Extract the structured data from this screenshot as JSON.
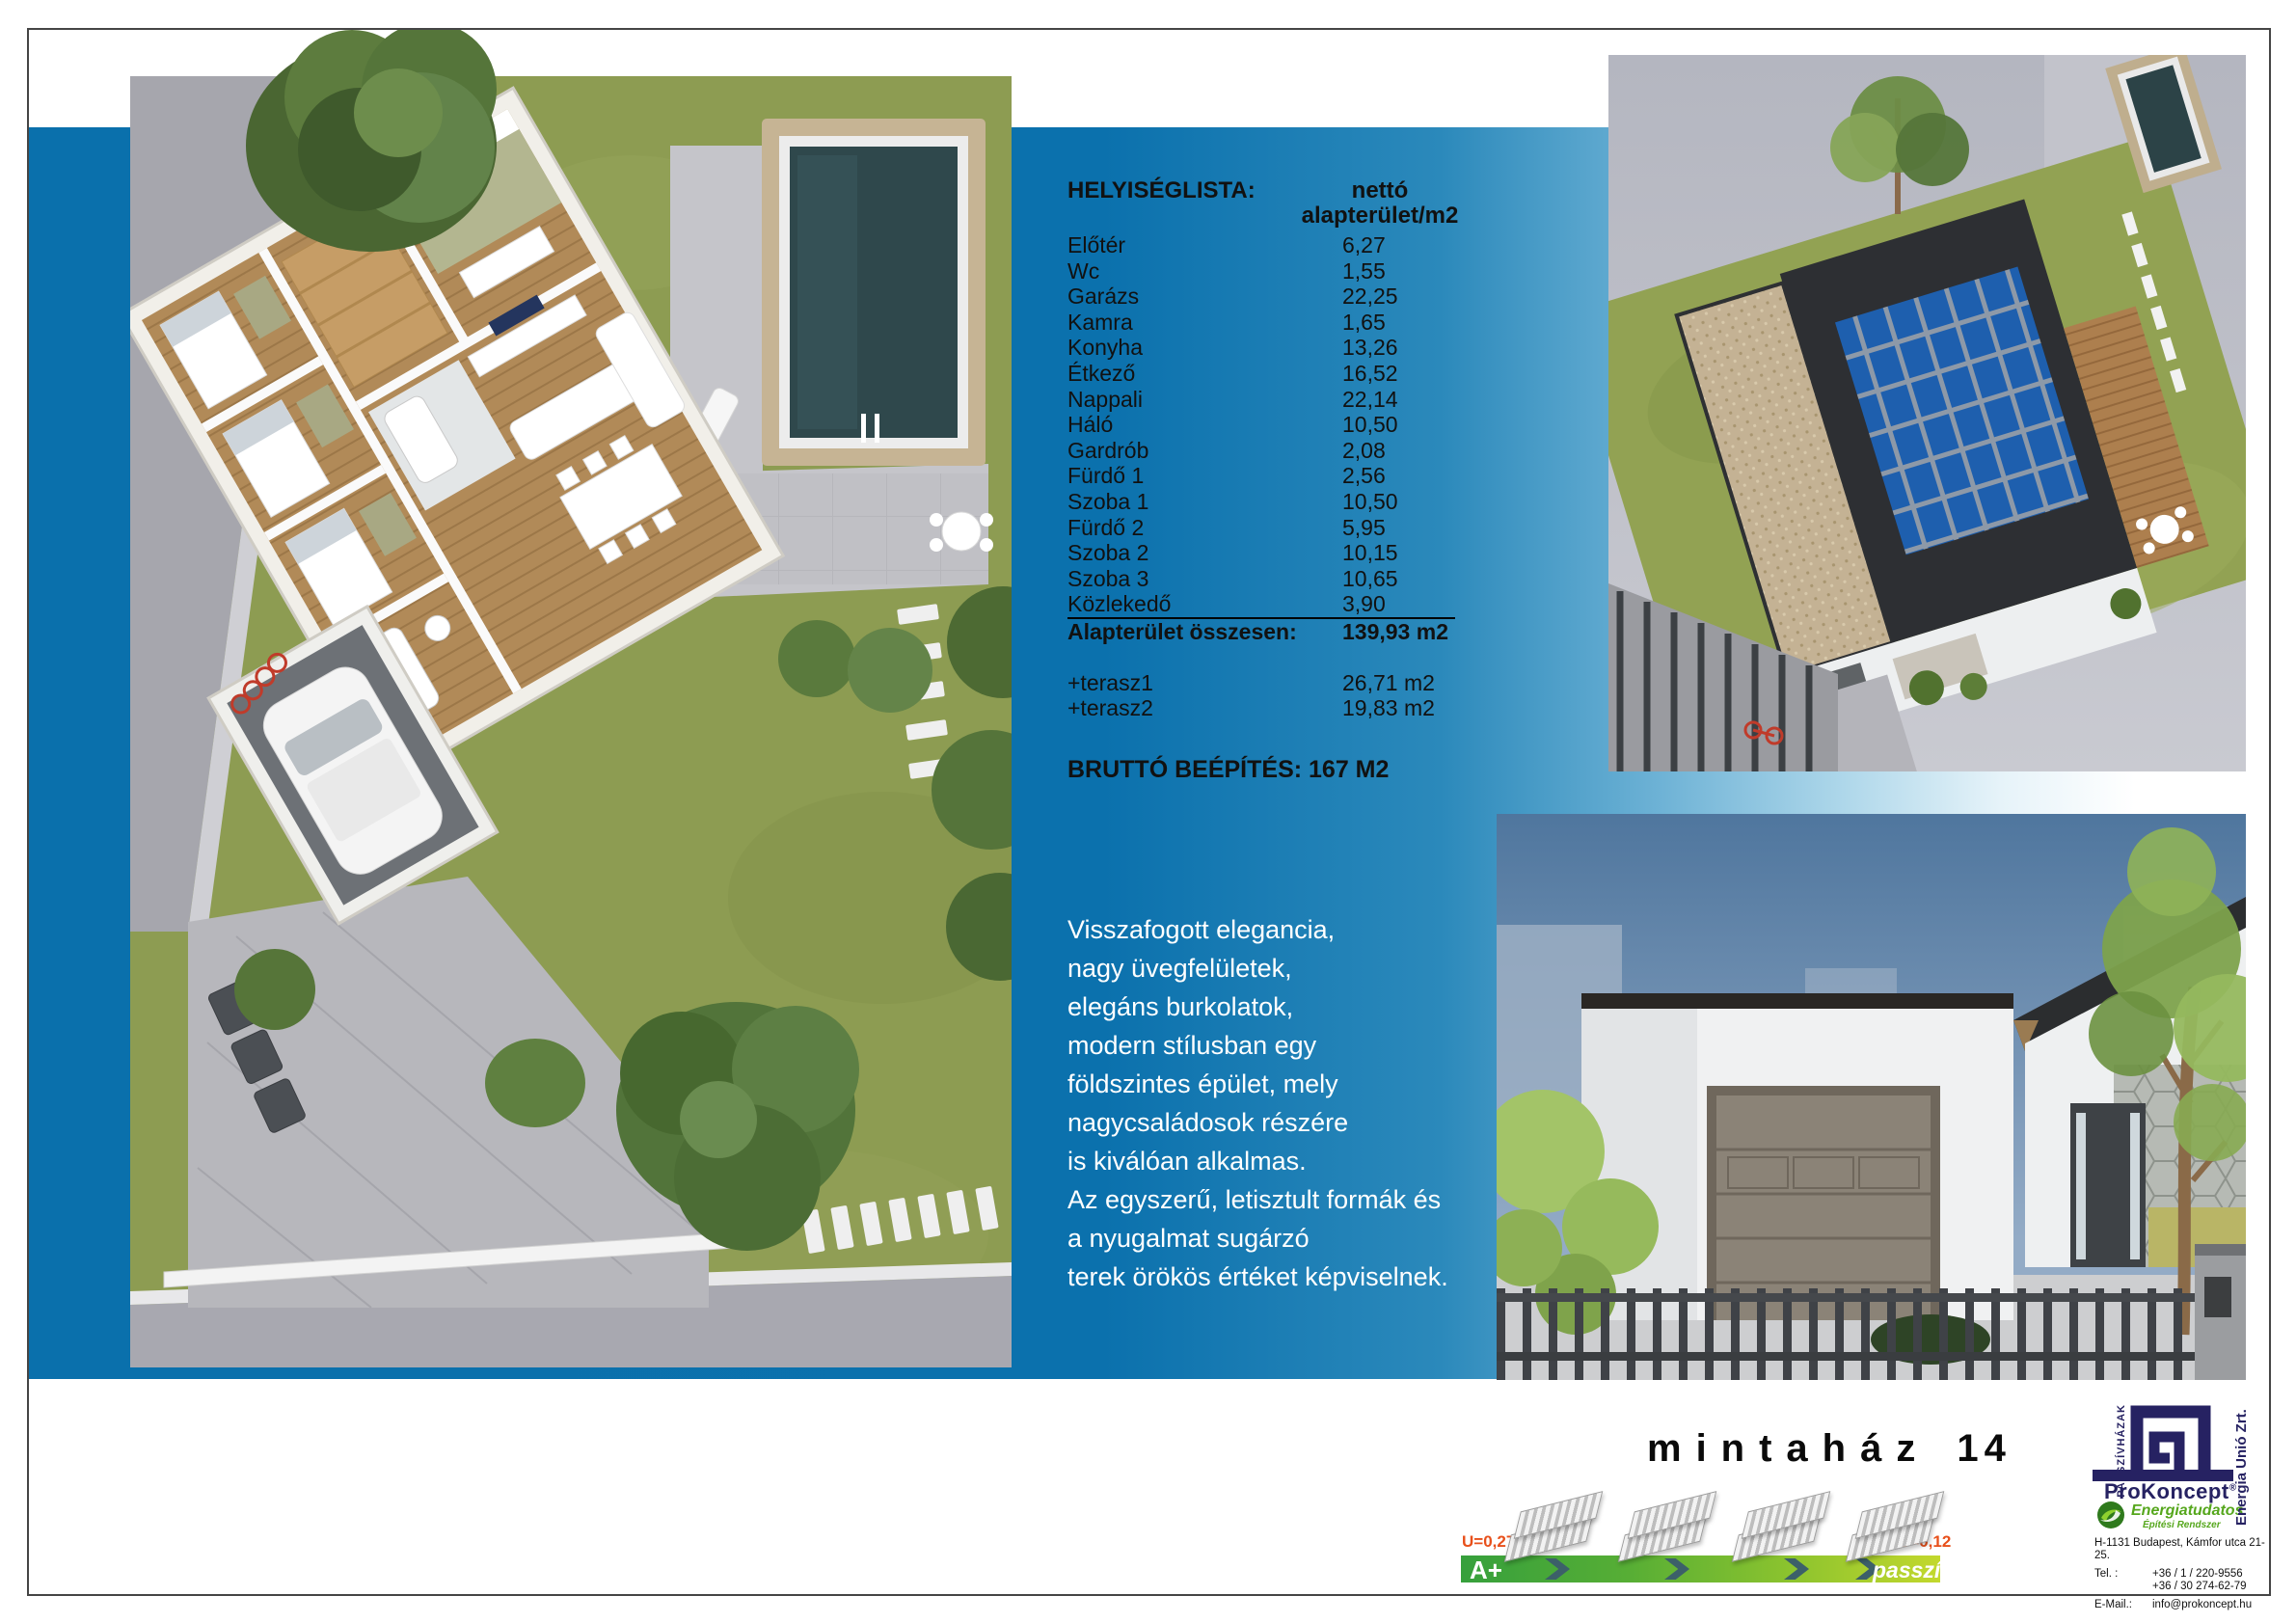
{
  "page": {
    "doc_type": "model house datasheet"
  },
  "title": {
    "word": "mintaház",
    "number": "14"
  },
  "room_list": {
    "heading": "HELYISÉGLISTA:",
    "col_header_line1": "nettó",
    "col_header_line2": "alapterület/m2",
    "rows": [
      {
        "name": "Előtér",
        "value": "6,27",
        "underline": false
      },
      {
        "name": "Wc",
        "value": "1,55",
        "underline": false
      },
      {
        "name": "Garázs",
        "value": "22,25",
        "underline": false
      },
      {
        "name": "Kamra",
        "value": "1,65",
        "underline": false
      },
      {
        "name": "Konyha",
        "value": "13,26",
        "underline": false
      },
      {
        "name": "Étkező",
        "value": "16,52",
        "underline": false
      },
      {
        "name": "Nappali",
        "value": "22,14",
        "underline": false
      },
      {
        "name": "Háló",
        "value": "10,50",
        "underline": false
      },
      {
        "name": "Gardrób",
        "value": "2,08",
        "underline": false
      },
      {
        "name": "Fürdő 1",
        "value": "2,56",
        "underline": false
      },
      {
        "name": "Szoba 1",
        "value": "10,50",
        "underline": false
      },
      {
        "name": "Fürdő 2",
        "value": "5,95",
        "underline": false
      },
      {
        "name": "Szoba 2",
        "value": "10,15",
        "underline": false
      },
      {
        "name": "Szoba 3",
        "value": "10,65",
        "underline": false
      },
      {
        "name": "Közlekedő",
        "value": "3,90",
        "underline": true
      }
    ],
    "total_label": "Alapterület összesen:",
    "total_value": "139,93 m2",
    "extras": [
      {
        "name": "+terasz1",
        "value": "26,71 m2"
      },
      {
        "name": "+terasz2",
        "value": "19,83 m2"
      }
    ],
    "gross": "BRUTTÓ BEÉPÍTÉS: 167 M2"
  },
  "description": {
    "lines": [
      "Visszafogott elegancia,",
      "nagy üvegfelületek,",
      "elegáns burkolatok,",
      "modern stílusban egy",
      "földszintes épület, mely",
      "nagycsaládosok részére",
      "is kiválóan alkalmas.",
      "Az egyszerű, letisztult formák és",
      "a nyugalmat sugárzó",
      "terek örökös értéket képviselnek."
    ]
  },
  "energy": {
    "u_left": "U=0,27",
    "u_right": "U=0,12",
    "rating": "A+",
    "passive_label": "passzív"
  },
  "branding": {
    "company": "ProKoncept",
    "registered_mark": "®",
    "tagline1": "Energiatudatos",
    "tagline2": "Építési Rendszer",
    "vertical_left": "PASSZÍVHÁZAK",
    "vertical_right": "Energia Unió Zrt.",
    "address": "H-1131 Budapest, Kámfor utca 21-25.",
    "tel_label": "Tel. :",
    "tel1": "+36 / 1 / 220-9556",
    "tel2": "+36 / 30 274-62-79",
    "email_label": "E-Mail.:",
    "email": "info@prokoncept.hu"
  },
  "images": {
    "floorplan_alt": "3D top-view floor plan with garden and pool",
    "aerial_alt": "aerial 3D render of house with rooftop solar panels",
    "front_alt": "street-front 3D render with garage and fence"
  },
  "colors": {
    "band_blue": "#0a70ac",
    "brand_navy": "#262262",
    "brand_green": "#56a71d",
    "u_value_orange": "#e8501b",
    "bar_green_start": "#36a03c",
    "bar_green_end": "#c3d82d",
    "description_text": "#ffffff",
    "body_text": "#111111"
  }
}
